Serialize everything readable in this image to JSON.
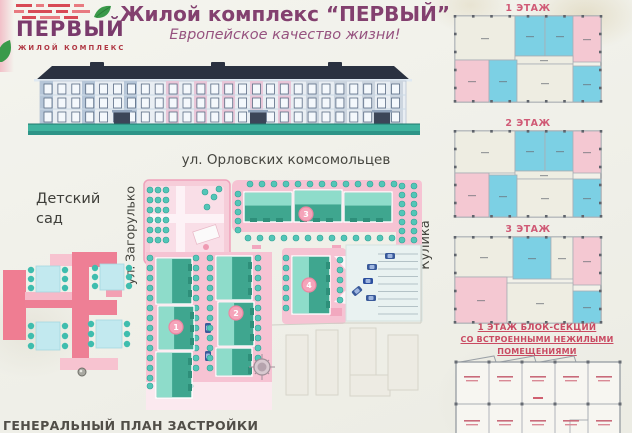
{
  "logo": {
    "title": "ПЕРВЫЙ",
    "subtitle": "ЖИЛОЙ КОМПЛЕКС"
  },
  "header": {
    "title": "Жилой комплекс “ПЕРВЫЙ”",
    "subtitle": "Европейское качество жизни!"
  },
  "site_plan": {
    "street_top": "ул. Орловских комсомольцев",
    "street_left": "ул. Загорулько",
    "street_right": "ул. Леонида Кулика",
    "kindergarten_label": "Детский сад",
    "caption": "ГЕНЕРАЛЬНЫЙ ПЛАН ЗАСТРОЙКИ",
    "buildings": [
      {
        "number": "1"
      },
      {
        "number": "2"
      },
      {
        "number": "3"
      },
      {
        "number": "4"
      }
    ]
  },
  "floor_plans": {
    "floors": [
      {
        "label": "1 ЭТАЖ"
      },
      {
        "label": "2 ЭТАЖ"
      },
      {
        "label": "3 ЭТАЖ"
      }
    ],
    "block_title_line1": "1 ЭТАЖ БЛОК-СЕКЦИЙ",
    "block_title_line2": "СО ВСТРОЕННЫМИ НЕЖИЛЫМИ ПОМЕЩЕНИЯМИ"
  },
  "colors": {
    "accent_purple": "#83406f",
    "accent_red": "#c94a62",
    "building_teal": "#3fa68f",
    "plan_pink": "#f6c3d3",
    "room_cyan": "#7cd0e4",
    "room_pink": "#f4c8d2"
  }
}
